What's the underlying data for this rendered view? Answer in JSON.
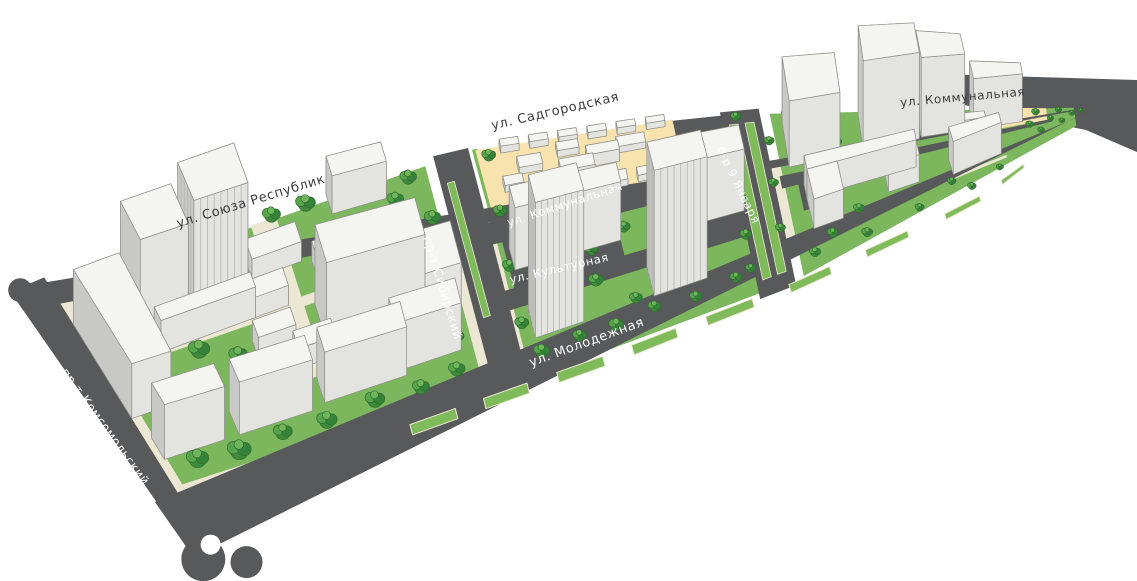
{
  "canvas": {
    "width": 1137,
    "height": 581,
    "background": "#ffffff"
  },
  "colors": {
    "road": "#58595b",
    "sidewalk": "#ece7d3",
    "lawn": "#7cb75e",
    "median_green": "#7fbb5b",
    "sand": "#f8e3ae",
    "building_top": "#f4f4f1",
    "building_south": "#e3e3df",
    "building_west": "#c8c8c4",
    "building_east": "#d9d9d5",
    "building_north": "#eeeeea",
    "building_stroke": "#8f8f8a",
    "stripe": "#b5b5b1",
    "tree_mid": "#3f8b3b",
    "tree_mid2": "#358338",
    "tree_light": "#58a44a",
    "tree_highlight": "#6fb65a",
    "tree_stroke": "#2d6c2f",
    "label_light": "#ffffff",
    "label_dark": "#3c3c3c",
    "white": "#ffffff"
  },
  "projection": {
    "top_rail": [
      [
        48,
        292
      ],
      [
        256,
        206
      ],
      [
        455,
        150
      ],
      [
        672,
        117
      ],
      [
        900,
        95
      ],
      [
        1088,
        108
      ]
    ],
    "bottom_rail": [
      [
        182,
        505
      ],
      [
        400,
        438
      ],
      [
        610,
        363
      ],
      [
        800,
        288
      ],
      [
        975,
        205
      ],
      [
        1088,
        118
      ]
    ],
    "shear": 0.36,
    "story_px_left": 11,
    "story_px_slope": 5.5
  },
  "streets": [
    {
      "label": "ул. Союза Республик",
      "x": 252,
      "y": 205,
      "rotate": -17,
      "size": 13,
      "tone": "dark"
    },
    {
      "label": "ул. Садгородская",
      "x": 556,
      "y": 115,
      "rotate": -13,
      "size": 13,
      "tone": "dark"
    },
    {
      "label": "ул. Коммунальная",
      "x": 963,
      "y": 101,
      "rotate": -5,
      "size": 12,
      "tone": "dark"
    },
    {
      "label": "ул. Коммунальная",
      "x": 566,
      "y": 208,
      "rotate": -18,
      "size": 11.5,
      "tone": "light"
    },
    {
      "label": "ул. Культурная",
      "x": 560,
      "y": 272,
      "rotate": -13,
      "size": 11.5,
      "tone": "light"
    },
    {
      "label": "ул. Молодежная",
      "x": 588,
      "y": 346,
      "rotate": -20,
      "size": 13,
      "tone": "light"
    },
    {
      "label": "пр-т Сибирский",
      "x": 439,
      "y": 289,
      "rotate": 73,
      "size": 12,
      "tone": "light"
    },
    {
      "label": "пр-т Комсомольский",
      "x": 102,
      "y": 429,
      "rotate": 54,
      "size": 12,
      "tone": "light"
    },
    {
      "label": "б-р 9 Января",
      "x": 735,
      "y": 187,
      "rotate": 64,
      "size": 11.5,
      "tone": "light"
    }
  ],
  "ground": {
    "base_block": [
      -0.01,
      0.0,
      1.01,
      0.96
    ],
    "lawns": [
      [
        0.015,
        0.03,
        0.353,
        0.89
      ],
      [
        0.415,
        0.405,
        0.245,
        0.55
      ],
      [
        0.685,
        0.04,
        0.3,
        0.915
      ],
      [
        0.415,
        0.01,
        0.005,
        0.39
      ]
    ],
    "sand": [
      [
        0.418,
        0.015,
        0.182,
        0.285
      ],
      [
        0.895,
        0.1,
        0.06,
        0.32
      ]
    ],
    "paths": [
      [
        0.05,
        0.36,
        0.31,
        0.04
      ],
      [
        0.19,
        0.06,
        0.025,
        0.62
      ],
      [
        0.7,
        0.76,
        0.2,
        0.03
      ]
    ],
    "inner_roads": [
      [
        0.405,
        0.315,
        0.26,
        0.09
      ],
      [
        0.405,
        0.595,
        0.26,
        0.08
      ],
      [
        0.42,
        0.405,
        0.11,
        0.195
      ],
      [
        0.6,
        0.02,
        0.062,
        0.58
      ],
      [
        0.685,
        0.42,
        0.275,
        0.07
      ],
      [
        0.7,
        0.49,
        0.035,
        0.15
      ],
      [
        0.85,
        0.49,
        0.035,
        0.13
      ]
    ],
    "road_bands": [
      [
        -0.028,
        -0.075,
        1.028,
        0.107
      ],
      [
        -0.03,
        0.955,
        1.05,
        0.265
      ],
      [
        -0.028,
        -0.06,
        0.032,
        1.21
      ],
      [
        0.378,
        0.0,
        0.034,
        0.98
      ],
      [
        0.642,
        0.0,
        0.034,
        0.98
      ]
    ],
    "medians_bottom_v": [
      0.965,
      1.005
    ],
    "medians_bottom_u": [
      [
        0.285,
        0.335
      ],
      [
        0.365,
        0.41
      ],
      [
        0.44,
        0.485
      ],
      [
        0.515,
        0.56
      ],
      [
        0.59,
        0.635
      ],
      [
        0.67,
        0.71
      ],
      [
        0.745,
        0.785
      ],
      [
        0.82,
        0.855
      ],
      [
        0.885,
        0.915
      ]
    ],
    "medians_side": [
      [
        0.6485,
        0.08,
        0.008,
        0.82
      ],
      [
        0.6625,
        0.08,
        0.008,
        0.82
      ],
      [
        0.384,
        0.12,
        0.007,
        0.55
      ]
    ],
    "screen_extras": [
      [
        [
          940,
          74
        ],
        [
          1137,
          80
        ],
        [
          1137,
          152
        ],
        [
          1086,
          130
        ],
        [
          940,
          100
        ]
      ]
    ],
    "circles": [
      {
        "u": -0.018,
        "v": 1.24,
        "r": 22,
        "color": "road"
      },
      {
        "u": 0.04,
        "v": 1.3,
        "r": 16,
        "color": "road"
      },
      {
        "u": -0.02,
        "v": -0.05,
        "r": 12,
        "color": "road"
      },
      {
        "u": 0.005,
        "v": 1.19,
        "r": 10,
        "color": "white"
      },
      {
        "u": 0.16,
        "v": 1.26,
        "r": 14,
        "color": "white"
      },
      {
        "u": 0.37,
        "v": 1.25,
        "r": 13,
        "color": "white"
      },
      {
        "u": 0.57,
        "v": 1.24,
        "r": 11,
        "color": "white"
      },
      {
        "u": 0.755,
        "v": 1.23,
        "r": 9,
        "color": "white"
      }
    ]
  },
  "buildings": [
    [
      0.004,
      0.16,
      0.046,
      0.44,
      5,
      0
    ],
    [
      0.055,
      0.13,
      0.05,
      0.17,
      9,
      0
    ],
    [
      0.115,
      0.1,
      0.055,
      0.16,
      10,
      1
    ],
    [
      0.066,
      0.33,
      0.1,
      0.06,
      3,
      0
    ],
    [
      0.268,
      0.03,
      0.055,
      0.08,
      4,
      0
    ],
    [
      0.175,
      0.17,
      0.05,
      0.08,
      2,
      0
    ],
    [
      0.235,
      0.26,
      0.045,
      0.08,
      2,
      0
    ],
    [
      0.16,
      0.32,
      0.04,
      0.07,
      2,
      0
    ],
    [
      0.225,
      0.42,
      0.105,
      0.15,
      8,
      0
    ],
    [
      0.155,
      0.47,
      0.04,
      0.07,
      2,
      0
    ],
    [
      0.19,
      0.56,
      0.04,
      0.07,
      2,
      0
    ],
    [
      0.315,
      0.44,
      0.05,
      0.17,
      5,
      0
    ],
    [
      0.012,
      0.7,
      0.075,
      0.1,
      5,
      0
    ],
    [
      0.105,
      0.7,
      0.085,
      0.1,
      5,
      0
    ],
    [
      0.205,
      0.685,
      0.09,
      0.1,
      5,
      0
    ],
    [
      0.285,
      0.66,
      0.07,
      0.1,
      5,
      0
    ],
    [
      0.44,
      0.012,
      0.017,
      0.032,
      0.8,
      0
    ],
    [
      0.467,
      0.012,
      0.017,
      0.032,
      0.8,
      0
    ],
    [
      0.494,
      0.012,
      0.017,
      0.032,
      0.8,
      0
    ],
    [
      0.521,
      0.012,
      0.017,
      0.032,
      0.8,
      0
    ],
    [
      0.548,
      0.012,
      0.017,
      0.032,
      0.8,
      0
    ],
    [
      0.575,
      0.012,
      0.017,
      0.032,
      0.8,
      0
    ],
    [
      0.452,
      0.1,
      0.022,
      0.05,
      0.8,
      0
    ],
    [
      0.488,
      0.17,
      0.032,
      0.055,
      1.5,
      0
    ],
    [
      0.545,
      0.085,
      0.026,
      0.05,
      0.8,
      0
    ],
    [
      0.578,
      0.19,
      0.022,
      0.045,
      0.8,
      0
    ],
    [
      0.52,
      0.245,
      0.028,
      0.05,
      0.8,
      0
    ],
    [
      0.462,
      0.245,
      0.02,
      0.042,
      0.8,
      0
    ],
    [
      0.435,
      0.175,
      0.018,
      0.04,
      0.8,
      0
    ],
    [
      0.515,
      0.13,
      0.03,
      0.045,
      1.5,
      0
    ],
    [
      0.558,
      0.25,
      0.02,
      0.04,
      0.8,
      0
    ],
    [
      0.49,
      0.065,
      0.02,
      0.04,
      0.8,
      0
    ],
    [
      0.425,
      0.44,
      0.105,
      0.09,
      7,
      0
    ],
    [
      0.428,
      0.695,
      0.048,
      0.115,
      15,
      1
    ],
    [
      0.548,
      0.675,
      0.052,
      0.13,
      15,
      1
    ],
    [
      0.605,
      0.42,
      0.042,
      0.13,
      8,
      0
    ],
    [
      0.695,
      0.1,
      0.046,
      0.28,
      9,
      0
    ],
    [
      0.762,
      0.12,
      0.05,
      0.26,
      13,
      0
    ],
    [
      0.814,
      0.13,
      0.048,
      0.24,
      12,
      0
    ],
    [
      0.872,
      0.15,
      0.055,
      0.22,
      8,
      0
    ],
    [
      0.705,
      0.5,
      0.1,
      0.08,
      4,
      0
    ],
    [
      0.705,
      0.58,
      0.028,
      0.17,
      4,
      0
    ],
    [
      0.777,
      0.58,
      0.028,
      0.11,
      4,
      0
    ],
    [
      0.835,
      0.6,
      0.06,
      0.12,
      5,
      0
    ],
    [
      0.85,
      0.32,
      0.035,
      0.08,
      2,
      0
    ]
  ],
  "trees": [
    [
      0.035,
      0.07,
      1
    ],
    [
      0.07,
      0.065,
      1.1
    ],
    [
      0.105,
      0.06,
      0.9
    ],
    [
      0.14,
      0.065,
      1
    ],
    [
      0.175,
      0.06,
      1.1
    ],
    [
      0.21,
      0.065,
      0.9
    ],
    [
      0.245,
      0.06,
      1
    ],
    [
      0.28,
      0.065,
      1
    ],
    [
      0.315,
      0.06,
      0.9
    ],
    [
      0.348,
      0.07,
      0.9
    ],
    [
      0.05,
      0.14,
      0.9
    ],
    [
      0.115,
      0.13,
      0.8
    ],
    [
      0.33,
      0.14,
      0.9
    ],
    [
      0.1,
      0.45,
      1
    ],
    [
      0.135,
      0.52,
      0.9
    ],
    [
      0.195,
      0.6,
      0.9
    ],
    [
      0.25,
      0.47,
      0.8
    ],
    [
      0.165,
      0.26,
      0.9
    ],
    [
      0.24,
      0.35,
      0.8
    ],
    [
      0.29,
      0.3,
      0.8
    ],
    [
      0.07,
      0.62,
      0.9
    ],
    [
      0.26,
      0.62,
      0.8
    ],
    [
      0.225,
      0.76,
      0.9
    ],
    [
      0.13,
      0.64,
      0.8
    ],
    [
      0.045,
      0.86,
      1
    ],
    [
      0.095,
      0.88,
      1.1
    ],
    [
      0.15,
      0.86,
      0.9
    ],
    [
      0.2,
      0.87,
      1
    ],
    [
      0.255,
      0.85,
      1
    ],
    [
      0.305,
      0.86,
      0.9
    ],
    [
      0.345,
      0.84,
      0.9
    ],
    [
      0.36,
      0.25,
      0.9
    ],
    [
      0.356,
      0.48,
      0.9
    ],
    [
      0.352,
      0.72,
      0.9
    ],
    [
      0.425,
      0.3,
      0.8
    ],
    [
      0.42,
      0.52,
      0.8
    ],
    [
      0.418,
      0.75,
      0.8
    ],
    [
      0.428,
      0.06,
      0.8
    ],
    [
      0.655,
      0.05,
      0.7
    ],
    [
      0.468,
      0.5,
      0.9
    ],
    [
      0.5,
      0.55,
      0.8
    ],
    [
      0.535,
      0.49,
      0.8
    ],
    [
      0.497,
      0.68,
      0.9
    ],
    [
      0.468,
      0.78,
      0.9
    ],
    [
      0.53,
      0.8,
      0.8
    ],
    [
      0.565,
      0.73,
      0.8
    ],
    [
      0.6,
      0.62,
      0.8
    ],
    [
      0.445,
      0.62,
      0.8
    ],
    [
      0.565,
      0.48,
      0.7
    ],
    [
      0.59,
      0.78,
      0.8
    ],
    [
      0.43,
      0.88,
      0.9
    ],
    [
      0.468,
      0.87,
      0.8
    ],
    [
      0.505,
      0.88,
      0.9
    ],
    [
      0.545,
      0.86,
      0.8
    ],
    [
      0.585,
      0.88,
      0.8
    ],
    [
      0.625,
      0.86,
      0.8
    ],
    [
      0.652,
      0.16,
      0.8
    ],
    [
      0.649,
      0.33,
      0.8
    ],
    [
      0.646,
      0.5,
      0.8
    ],
    [
      0.643,
      0.68,
      0.8
    ],
    [
      0.64,
      0.84,
      0.7
    ],
    [
      0.681,
      0.22,
      0.7
    ],
    [
      0.678,
      0.46,
      0.7
    ],
    [
      0.675,
      0.7,
      0.7
    ],
    [
      0.7,
      0.07,
      0.8
    ],
    [
      0.735,
      0.065,
      0.9
    ],
    [
      0.77,
      0.07,
      0.8
    ],
    [
      0.808,
      0.065,
      0.8
    ],
    [
      0.845,
      0.07,
      0.8
    ],
    [
      0.878,
      0.065,
      0.7
    ],
    [
      0.715,
      0.42,
      0.8
    ],
    [
      0.745,
      0.5,
      0.7
    ],
    [
      0.775,
      0.47,
      0.7
    ],
    [
      0.8,
      0.64,
      0.7
    ],
    [
      0.748,
      0.74,
      0.8
    ],
    [
      0.72,
      0.82,
      0.8
    ],
    [
      0.832,
      0.78,
      0.7
    ],
    [
      0.862,
      0.55,
      0.6
    ],
    [
      0.74,
      0.3,
      0.7
    ],
    [
      0.77,
      0.26,
      0.7
    ],
    [
      0.7,
      0.88,
      0.8
    ],
    [
      0.75,
      0.89,
      0.8
    ],
    [
      0.8,
      0.87,
      0.7
    ],
    [
      0.85,
      0.88,
      0.7
    ],
    [
      0.888,
      0.86,
      0.6
    ],
    [
      0.918,
      0.28,
      0.7
    ],
    [
      0.943,
      0.24,
      0.7
    ],
    [
      0.968,
      0.21,
      0.6
    ],
    [
      0.934,
      0.48,
      0.7
    ],
    [
      0.958,
      0.44,
      0.6
    ],
    [
      0.982,
      0.38,
      0.55
    ],
    [
      0.945,
      0.64,
      0.6
    ],
    [
      0.97,
      0.58,
      0.55
    ],
    [
      0.992,
      0.3,
      0.5
    ]
  ]
}
